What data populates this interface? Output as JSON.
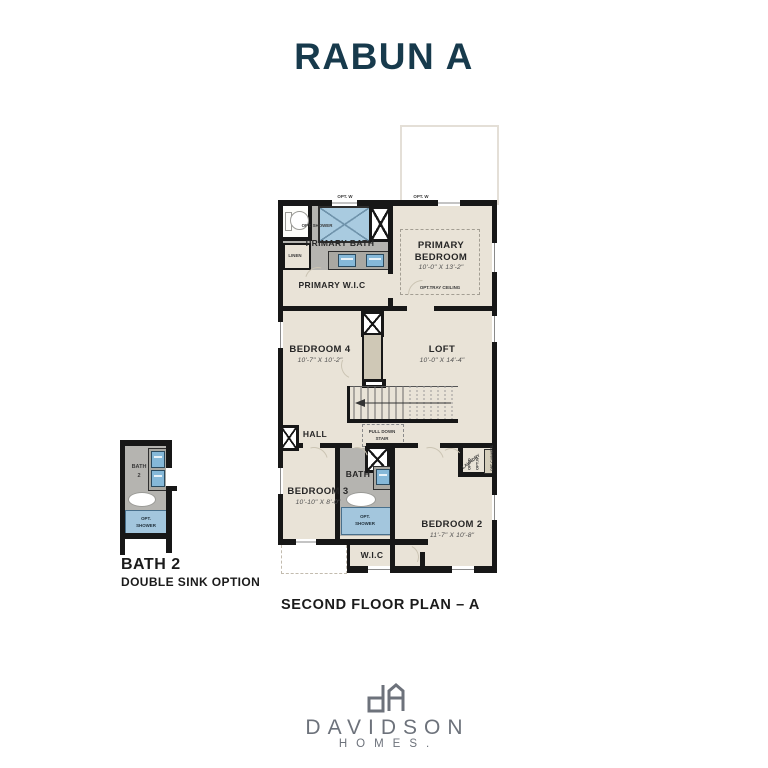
{
  "title": "RABUN A",
  "caption": "SECOND FLOOR PLAN – A",
  "plan": {
    "primary_bath": "PRIMARY BATH",
    "primary_bedroom": {
      "name": "PRIMARY BEDROOM",
      "dims": "10'-0\" X 13'-2\"",
      "note": "OPT.TRAY CEILING"
    },
    "primary_wic": "PRIMARY W.I.C",
    "linen": "LINEN",
    "opt_shower_small": "OPT. SHOWER",
    "opt_window_left": "OPT. W",
    "opt_window_right": "OPT. W",
    "bedroom4": {
      "name": "BEDROOM 4",
      "dims": "10'-7\" X 10'-2\""
    },
    "loft": {
      "name": "LOFT",
      "dims": "10'-0\" X 14'-4\""
    },
    "hall": "HALL",
    "pull_down_stair": {
      "line1": "PULL DOWN",
      "line2": "STAIR"
    },
    "bath": {
      "name": "BATH",
      "opt_shower_line1": "OPT.",
      "opt_shower_line2": "SHOWER"
    },
    "bedroom3": {
      "name": "BEDROOM 3",
      "dims": "10'-10\" X 8'-0\""
    },
    "bedroom2": {
      "name": "BEDROOM 2",
      "dims": "11'-7\" X 10'-8\""
    },
    "wic": "W.I.C",
    "laundry": "LAUNDRY",
    "opt_d": "OPT.D",
    "opt_w": "OPT.W",
    "opt_cabinets": "OPT. CABINETS"
  },
  "inset": {
    "room_line1": "BATH",
    "room_line2": "2",
    "opt_shower_line1": "OPT.",
    "opt_shower_line2": "SHOWER",
    "caption_line1": "BATH 2",
    "caption_line2": "DOUBLE SINK OPTION"
  },
  "brand": {
    "name": "DAVIDSON",
    "sub": "HOMES."
  },
  "colors": {
    "title": "#173A4C",
    "floor": "#E9E3D7",
    "bath_floor": "#B5B4B0",
    "shower_blue": "#A3C6DD",
    "wall": "#171717",
    "logo_gray": "#6D727B"
  }
}
